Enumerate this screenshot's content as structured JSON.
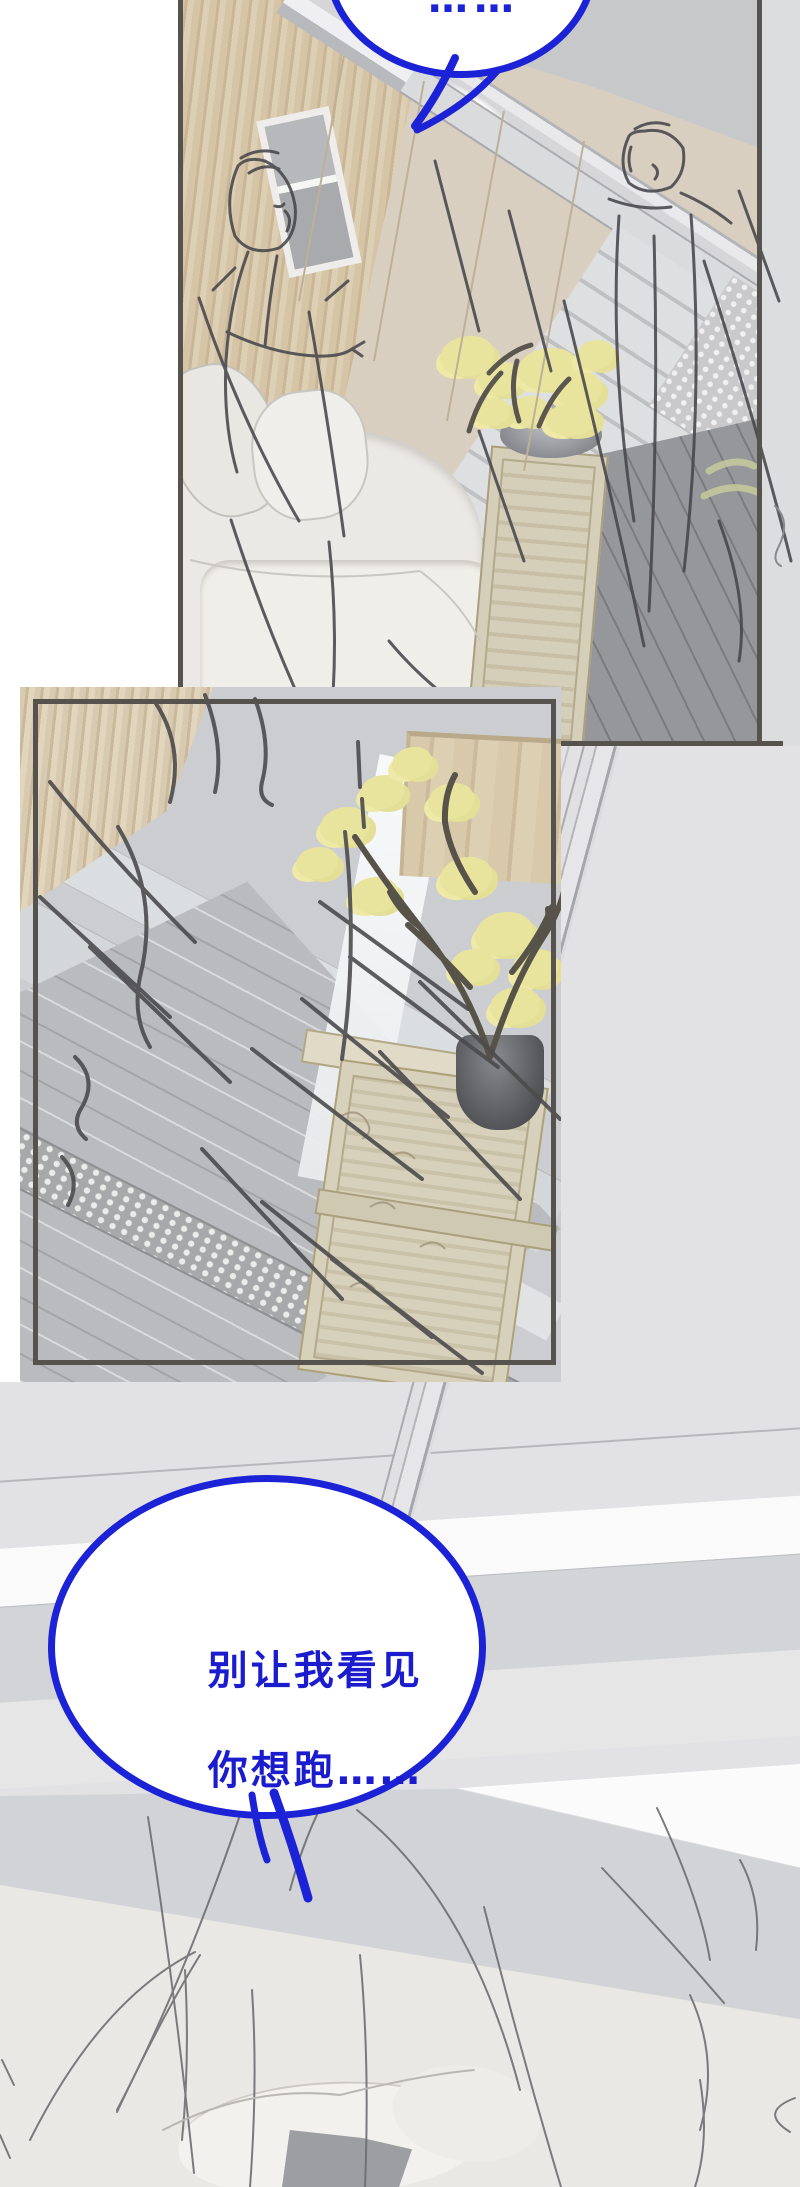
{
  "page": {
    "kind": "webtoon-comic-page",
    "width": 800,
    "height": 2187,
    "background": "#ffffff"
  },
  "style": {
    "accent_blue": "#1c22d6",
    "text_blue": "#1b1ccd",
    "panel_border": "#56524e",
    "scene_background": "#e2e2e4",
    "beige_background": "#eae8e5",
    "sketch_stroke": "#47464b",
    "blossom_yellow": "#e9e49d"
  },
  "panels": [
    {
      "id": "panel-1",
      "description": "framed interior panel: wood wall, window, marble stair beam, white sofa, blossom plant on carved pedestal, two rough figure sketches"
    },
    {
      "id": "panel-2",
      "description": "framed interior panel: glossy hallway corner, wooden cabinet, blossom branches in dark vase on carved stone pedestal, pebble strip, charcoal scribbles"
    },
    {
      "id": "scene-bottom",
      "description": "full-bleed closing scene: pale wall bands, diagonal window beam, rough sketched head with pillow"
    }
  ],
  "speech_bubbles": [
    {
      "id": "bubble-top-partial",
      "text": "……"
    },
    {
      "id": "bubble-main",
      "lines": [
        "别让我看见",
        "你想跑……"
      ]
    }
  ]
}
